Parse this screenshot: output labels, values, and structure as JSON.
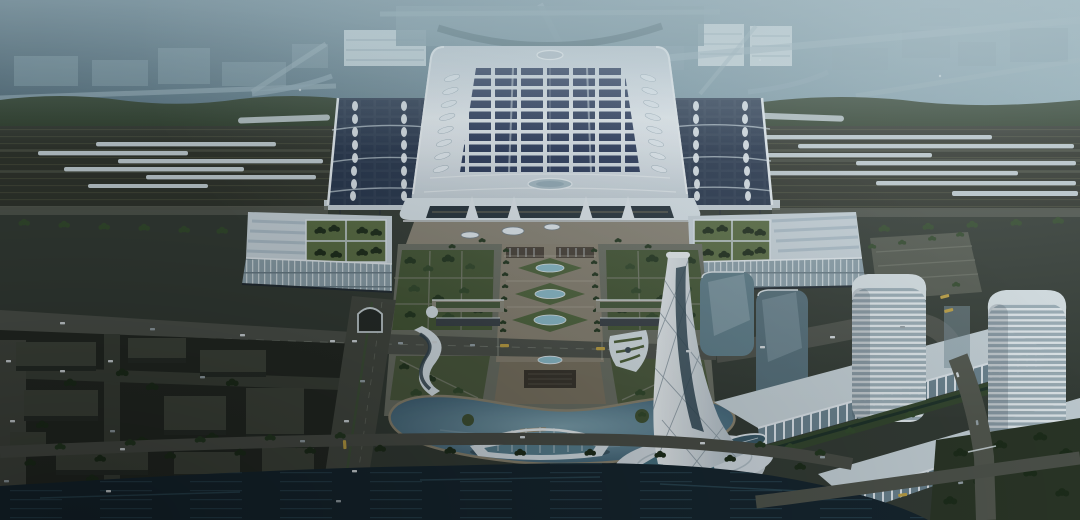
{
  "meta": {
    "description": "Aerial dusk architectural rendering of a high-speed railway station complex: solar-roof terminal spanning a rail yard with trains, twin wing buildings with rooftop gardens, central landscaped plaza axis, lake with arched pavilion bridge, twisted lattice tower, high-rise cluster on podiums, and a canal along the south edge"
  },
  "palette": {
    "sky_left": "#4a6472",
    "sky_mid": "#6f8d9a",
    "sky_right": "#95b1bb",
    "fog": "#a7bcc4",
    "far_building": "#839eaa",
    "rail_yard": "#2f322a",
    "track_line": "#454838",
    "train": "#c4cfd3",
    "roof_edge": "#c6d1d9",
    "roof_light": "#edf2f6",
    "solar_panel": "#253455",
    "hall_roof": "#2c3a50",
    "skylight": "#e7eef3",
    "facade_glass": "#232f38",
    "wing_roof": "#ccd7de",
    "roof_garden": "#5a6c41",
    "wing_facade": "#8fa2ac",
    "plaza": "#6c6f63",
    "promenade": "#8a8372",
    "lawn": "#465735",
    "pond": "#8fc0cf",
    "lake_deep": "#34556a",
    "lake_light": "#7fa3b0",
    "shore": "#8d8570",
    "bridge_glass": "#4a7486",
    "tower_light": "#f0f4f6",
    "tower_shade": "#aebac3",
    "tower_glass": "#2e4450",
    "floor_light": "#e8eef1",
    "floor_dark": "#9fb0b9",
    "podium_roof": "#c9d4da",
    "podium_glass": "#6d8490",
    "road": "#4e5149",
    "road_dark": "#3b3f36",
    "canal": "#15232c",
    "canal_streak": "#31505d",
    "district_block": "#3f4439",
    "district_side": "#272b24",
    "park": "#2b3524",
    "bus": "#c3a343",
    "tree": "#24371f"
  },
  "scene": {
    "sky": "fog-covered city skyline at dusk",
    "railway": {
      "label": "rail yard with high-speed trains",
      "trains_left": 6,
      "trains_right": 7
    },
    "terminal": {
      "label": "main station hall with rooftop solar array",
      "skylight_leaves_per_side": 8,
      "roof_ovals": 2
    },
    "wings": {
      "label": "commercial wing buildings with rooftop tree gardens",
      "count": 2
    },
    "plaza": {
      "label": "central axis plaza",
      "axis_ponds": 3,
      "forecourt_ovals": 3
    },
    "lake": {
      "label": "landscape lake with arched pavilion bridge and piers"
    },
    "tower": {
      "label": "twisted white lattice tower on swirl podium"
    },
    "highrises": {
      "label": "rounded high-rise cluster on long podium blocks",
      "count": 4
    },
    "canal": {
      "label": "tree-lined canal along the south edge"
    },
    "district": {
      "label": "low-rise city blocks, bottom-left"
    }
  }
}
